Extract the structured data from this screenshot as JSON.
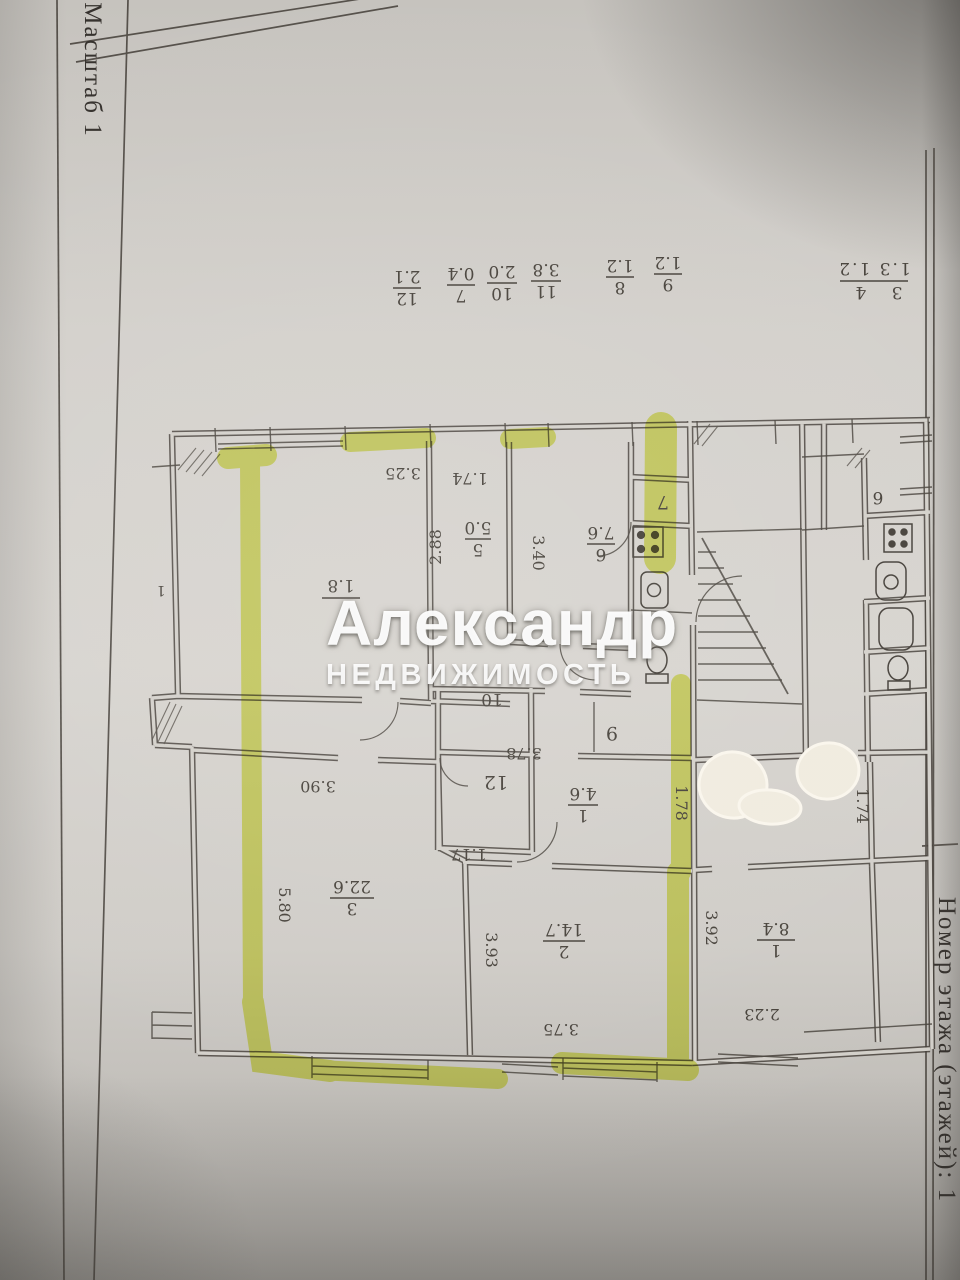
{
  "margins": {
    "left_label": "Масштаб 1",
    "right_label": "Номер этажа (этажей): 1"
  },
  "watermark": {
    "line1": "Александр",
    "line2": "НЕДВИЖИМОСТЬ"
  },
  "strip": {
    "items": [
      {
        "room": "12",
        "area": "2.1"
      },
      {
        "room": "7",
        "area": "0.4"
      },
      {
        "room": "10",
        "area": "2.0"
      },
      {
        "room": "11",
        "area": "3.8"
      },
      {
        "room": "8",
        "area": "1.2"
      },
      {
        "room": "9",
        "area": "1.2"
      }
    ],
    "corner_rooms": "3 4",
    "corner_areas": "1.3 1.2"
  },
  "labels": {
    "r5n": "5",
    "r5a": "5.0",
    "r6n": "6",
    "r6a": "7.6",
    "r7": "7",
    "rAa": "1.8",
    "r9": "9",
    "r10": "10",
    "r12": "12",
    "r1n": "1",
    "r1a": "4.6",
    "r3n": "3",
    "r3a": "22.6",
    "r2n": "2",
    "r2a": "14.7",
    "rr1n": "1",
    "rr1a": "8.4",
    "rr6": "6",
    "edge": "1"
  },
  "dims": {
    "d325": "3.25",
    "d174a": "1.74",
    "d288": "2.88",
    "d340": "3.40",
    "d390": "3.90",
    "d580": "5.80",
    "d393": "3.93",
    "d375": "3.75",
    "d378": "3.78",
    "d117": "1.17",
    "d178": "1.78",
    "d392": "3.92",
    "d223": "2.23",
    "d174b": "1.74"
  },
  "colors": {
    "highlighter": "#dce73e",
    "ink": "#45403a",
    "paper": "#d3d0ca",
    "whiteout": "#f0ebdf"
  }
}
